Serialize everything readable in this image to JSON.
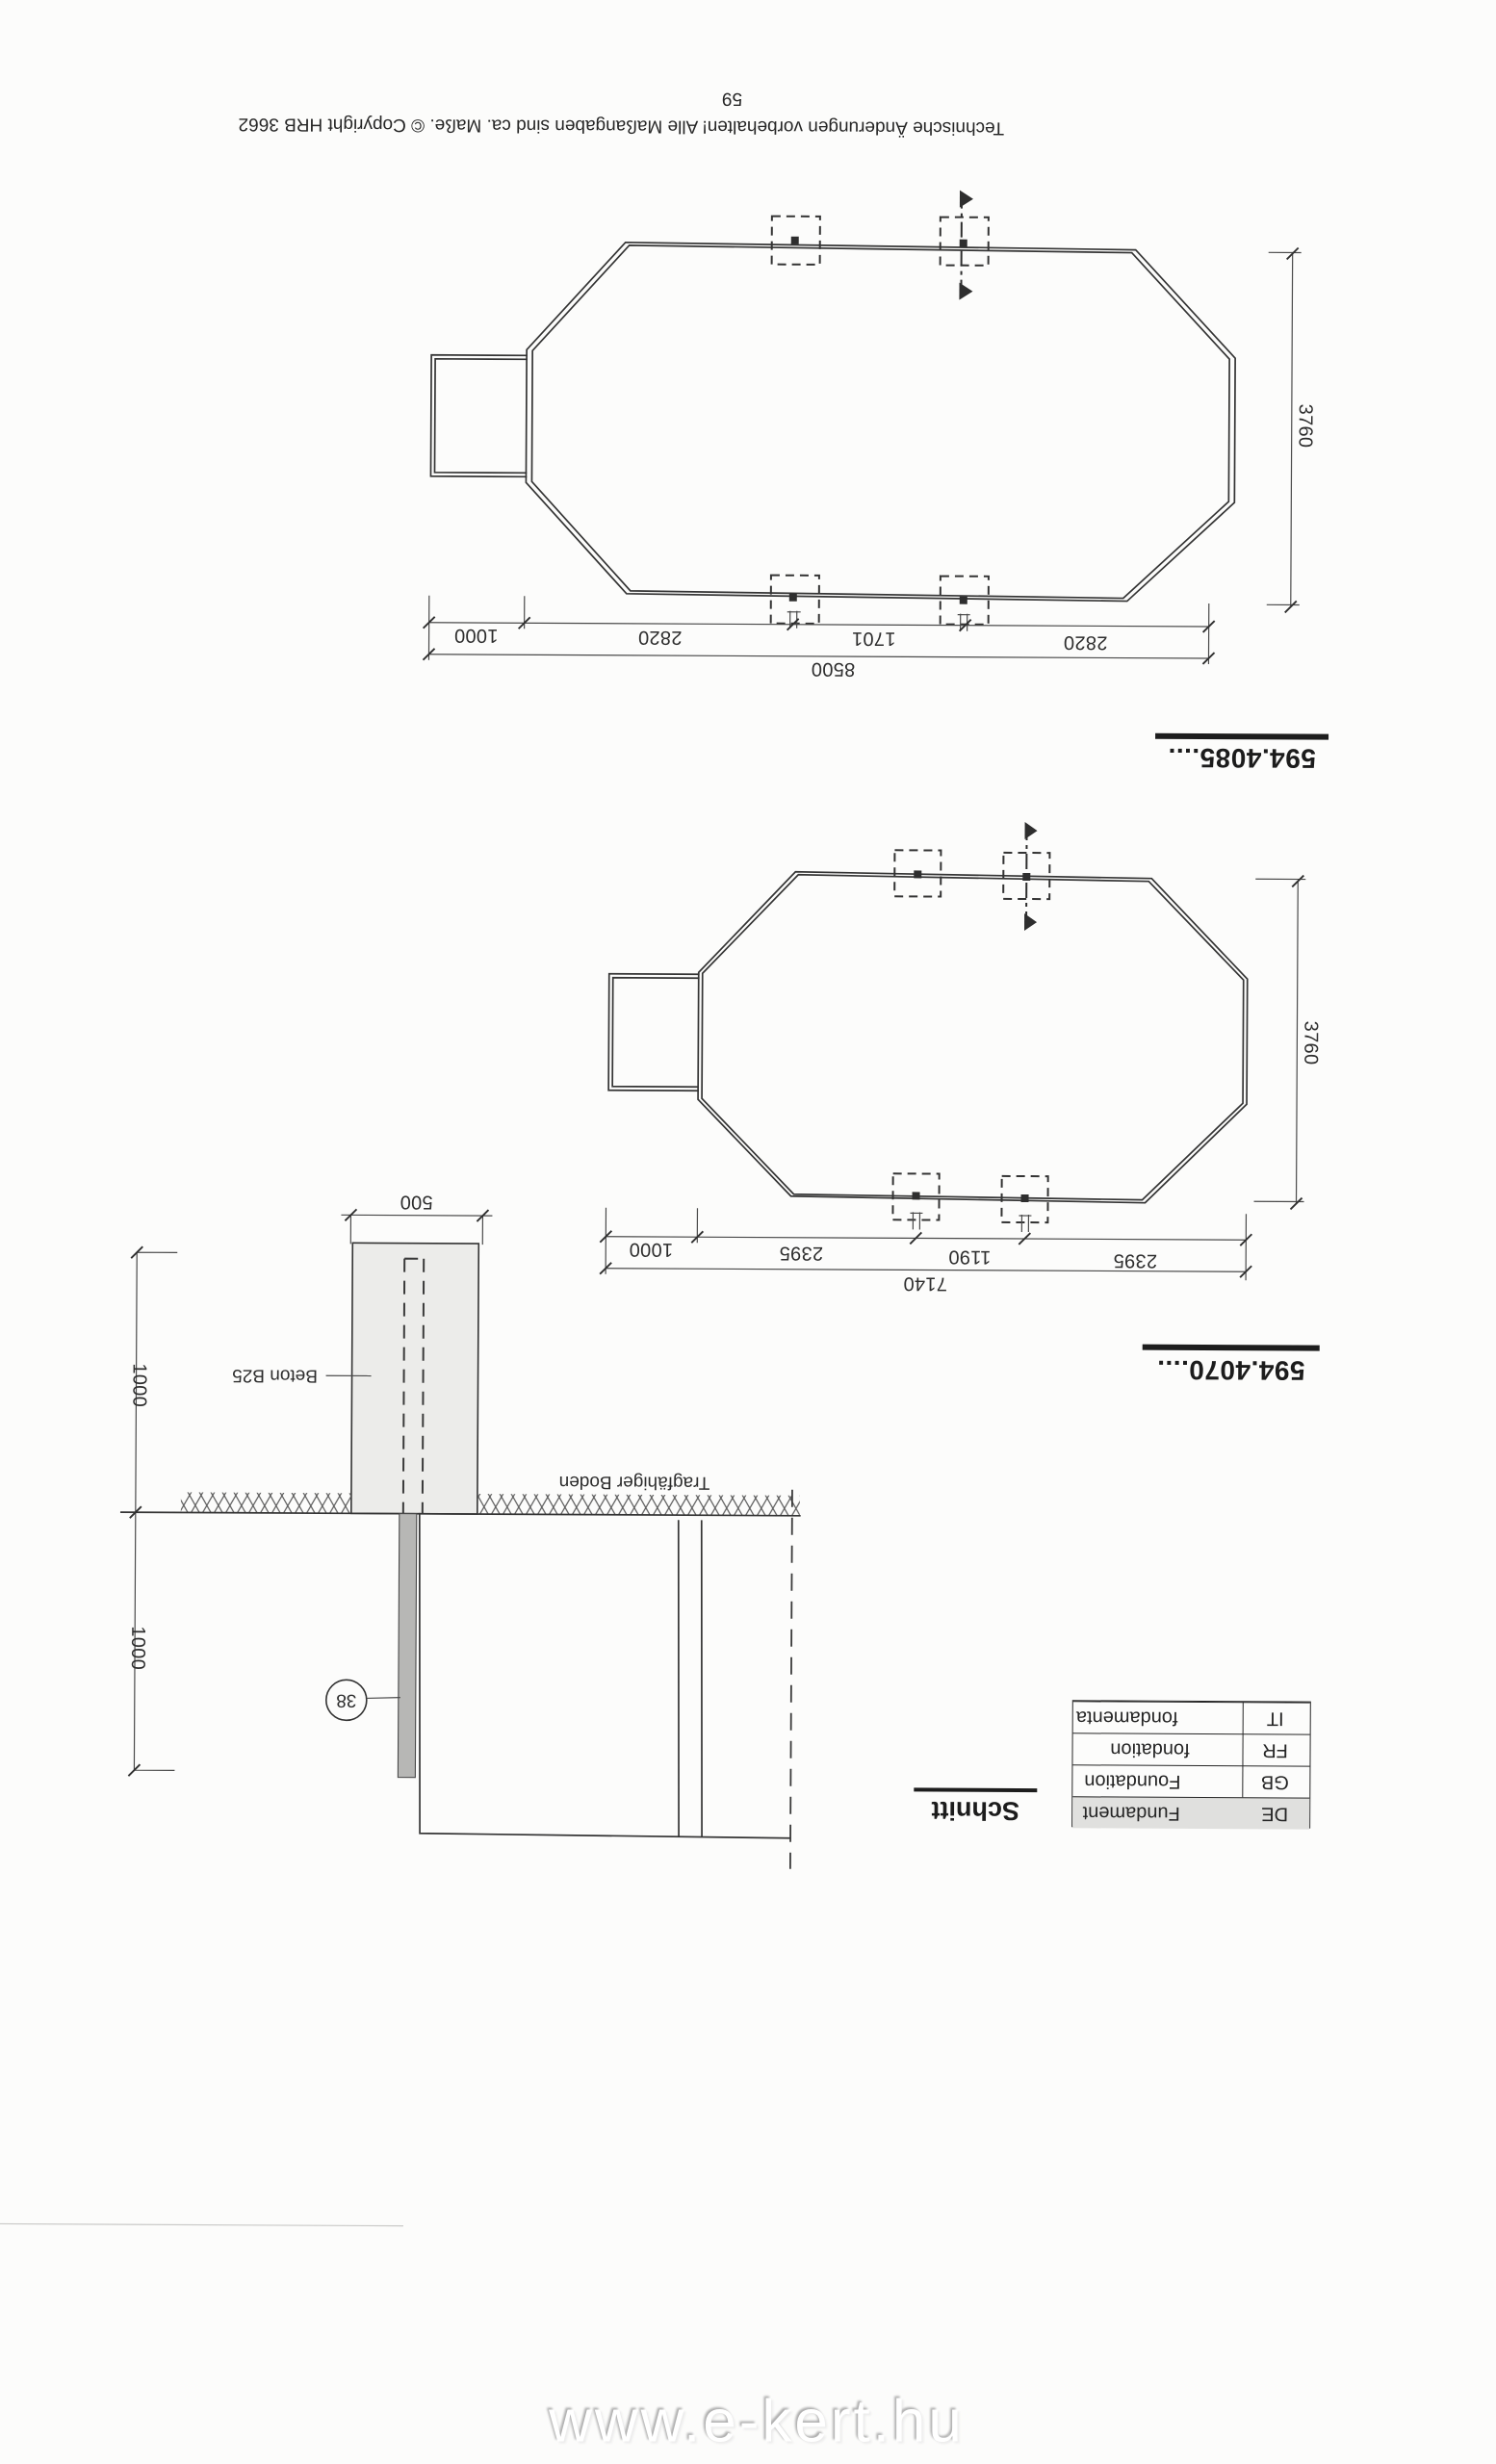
{
  "page": {
    "number": "59",
    "copyright_line": "Technische Änderungen vorbehalten!  Alle Maßangaben sind ca. Maße.   © Copyright HRB 3662",
    "watermark": "www.e-kert.hu"
  },
  "plan_4085": {
    "model": "594.4085....",
    "total_length": "8500",
    "chain": [
      "1000",
      "2820",
      "1701",
      "2820"
    ],
    "width": "3760"
  },
  "plan_4070": {
    "model": "594.4070....",
    "total_length": "7140",
    "chain": [
      "1000",
      "2395",
      "1190",
      "2395"
    ],
    "width": "3760"
  },
  "section": {
    "title": "Schnitt",
    "block_width": "500",
    "depth_upper": "1000",
    "depth_lower": "1000",
    "concrete": "Beton B25",
    "soil": "Tragfähiger Boden",
    "detail_ref": "38",
    "legend": [
      {
        "lang": "IT",
        "term": "fondamenta"
      },
      {
        "lang": "FR",
        "term": "fondation"
      },
      {
        "lang": "GB",
        "term": "Foundation"
      },
      {
        "lang": "DE",
        "term": "Fundament"
      }
    ]
  }
}
